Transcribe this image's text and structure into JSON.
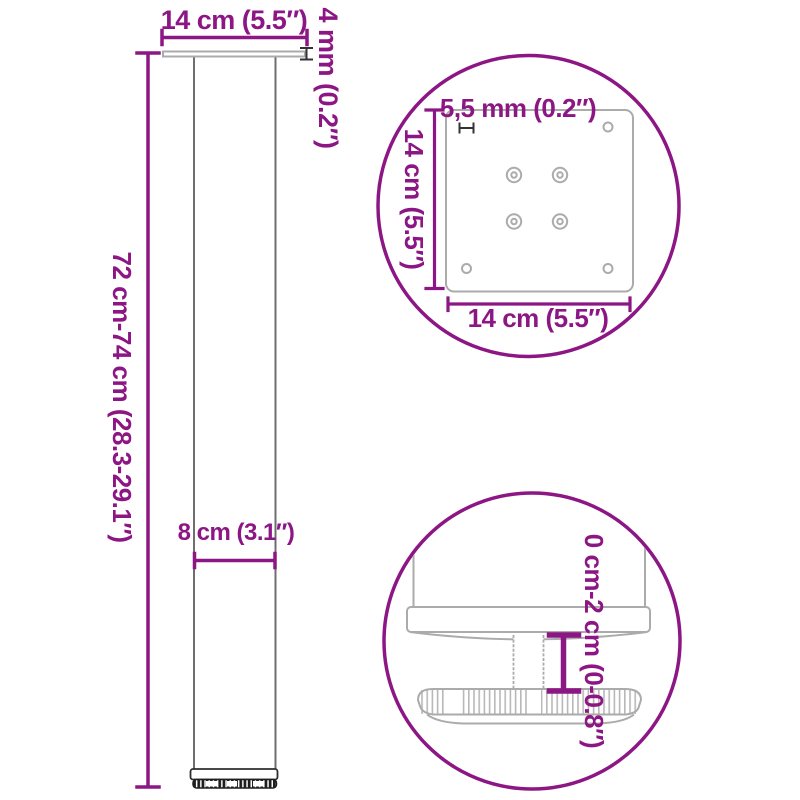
{
  "colors": {
    "accent": "#8D1685",
    "line_gray": "#ABABAB",
    "marker_dark": "#333333"
  },
  "leg": {
    "top_width_label": "14 cm (5.5″)",
    "plate_thickness_label": "4 mm (0.2″)",
    "height_range_label": "72 cm-74 cm (28.3-29.1″)",
    "tube_width_label": "8 cm (3.1″)"
  },
  "plate_detail": {
    "hole_diameter_label": "5,5 mm (0.2″)",
    "plate_depth_label": "14 cm (5.5″)",
    "plate_width_label": "14 cm (5.5″)"
  },
  "foot_detail": {
    "height_adjustment_label": "0 cm-2 cm (0-0.8″)"
  }
}
